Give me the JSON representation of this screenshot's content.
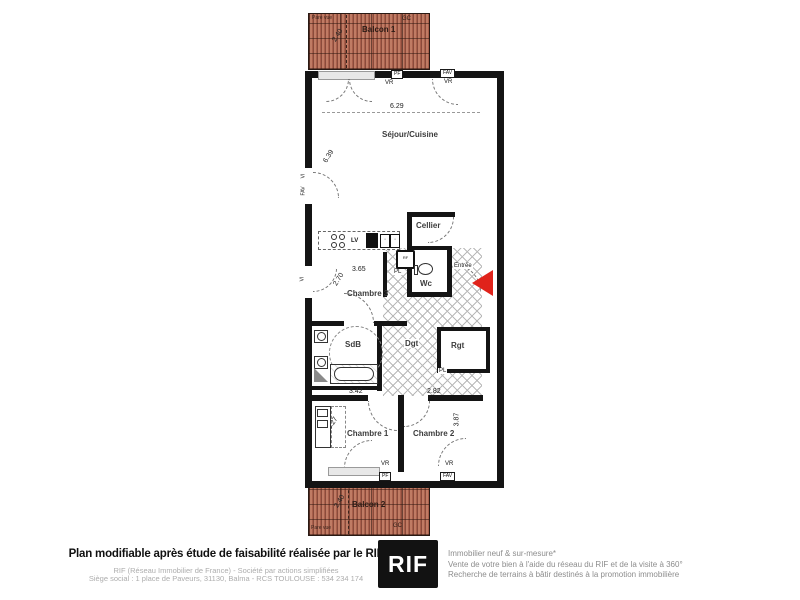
{
  "plan": {
    "balcon1": {
      "label": "Balcon 1",
      "dim": "2.40",
      "pare_vue": "Pare vue",
      "gc": "GC"
    },
    "balcon2": {
      "label": "Balcon 2",
      "dim": "2.40",
      "pare_vue": "Pare vue",
      "gc": "GC"
    },
    "rooms": {
      "sejour": {
        "label": "Séjour/Cuisine",
        "dim_w": "6.29",
        "dim_h": "6.39"
      },
      "cellier": {
        "label": "Cellier"
      },
      "entree": {
        "label": "Entrée"
      },
      "wc": {
        "label": "Wc"
      },
      "chambre3": {
        "label": "Chambre 3",
        "dim_w": "3.65",
        "dim_h": "2.70"
      },
      "sdb": {
        "label": "SdB"
      },
      "dgt": {
        "label": "Dgt"
      },
      "rgt": {
        "label": "Rgt"
      },
      "chambre1": {
        "label": "Chambre 1",
        "dim_w": "3.42",
        "dim_h": "3.27"
      },
      "chambre2": {
        "label": "Chambre 2",
        "dim_w": "2.82",
        "dim_h": "3.87"
      }
    },
    "tags": {
      "lv": "LV",
      "rf": "RF",
      "pl": "PL",
      "vr": "VR",
      "fav": "FAV",
      "vi": "VI",
      "pf": "PF"
    },
    "colors": {
      "balcony": "#a85f4b",
      "entrance_arrow": "#e0231b",
      "wall": "#141414"
    }
  },
  "footer": {
    "main": "Plan modifiable après étude de faisabilité réalisée par le RIF",
    "sub1": "RIF (Réseau Immobilier de France) - Société par actions simplifiées",
    "sub2": "Siège social : 1 place de Paveurs, 31130, Balma - RCS TOULOUSE : 534 234 174",
    "logo": "RIF",
    "tagline1": "Immobilier neuf & sur-mesure*",
    "tagline2": "Vente de votre bien à l'aide du réseau du RIF et de la visite à 360°",
    "tagline3": "Recherche de terrains à bâtir destinés à la promotion immobilière"
  }
}
